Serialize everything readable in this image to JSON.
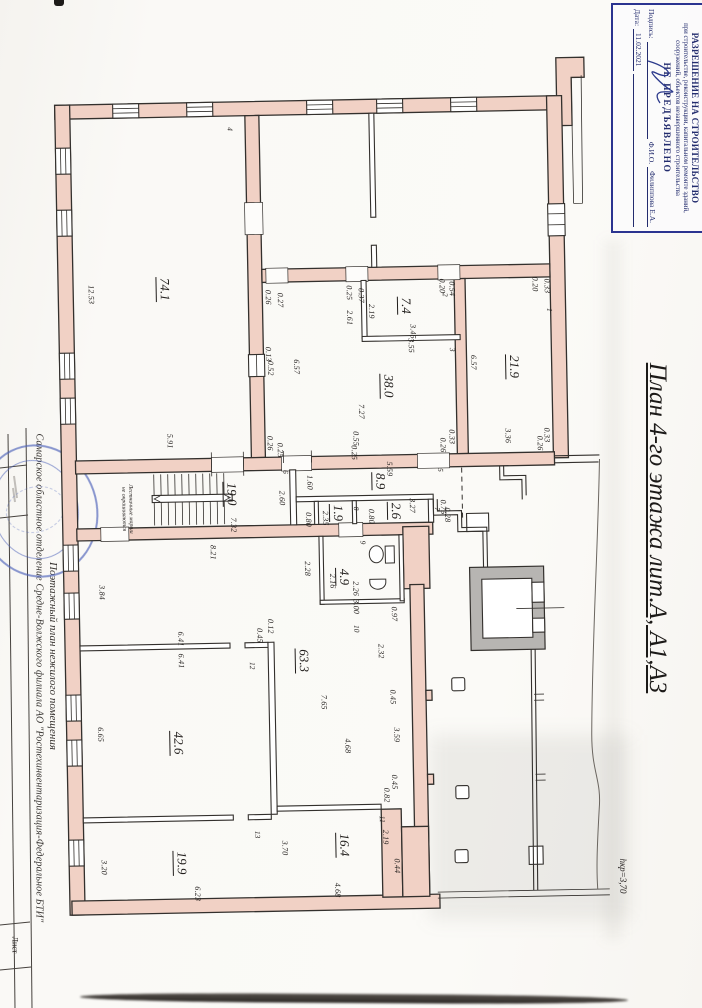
{
  "colors": {
    "wall": "#f1d1c5",
    "line": "#33302d",
    "stamp_blue": "#2b3490",
    "stamp_text": "#232c6e",
    "seal_blue": "#4a5fb8",
    "shaft_gray": "#b7b5b2",
    "paper": "#faf9f6"
  },
  "document": {
    "title_vertical": "План 4-го этажа лит.А, А1,А3",
    "height_note": "hкр=3,70",
    "left_margin": {
      "organization": "Самарское областное отделение Средне-Волжского филиала АО \"Ростехинвентаризация-Федеральное БТИ\"",
      "plan_type": "Поэтажный план нежилого помещения",
      "sheet_label": "Лист"
    },
    "permit_stamp": {
      "line1": "РАЗРЕШЕНИЕ НА СТРОИТЕЛЬСТВО",
      "line2": "при строительстве, реконструкции, капитальном ремонте зданий, сооружений, объектов незавершенного строительства",
      "line3": "НЕ ПРЕДЪЯВЛЕНО",
      "signature_label": "Подпись:",
      "fio_label": "Ф.И.О.",
      "fio_value": "Филиппова Е.А.",
      "date_label": "Дата:",
      "date_value": "11.02.2021"
    },
    "stairs_note_line1": "Лестничные марши",
    "stairs_note_line2": "не окрашиваются"
  },
  "plan": {
    "rooms": [
      {
        "number": "4",
        "area": "74.1",
        "ax": 106,
        "ay": 198,
        "nx": 175,
        "ny": 39
      },
      {
        "number": "2",
        "area": "7.4",
        "ax": 347,
        "ay": 219,
        "nx": 387,
        "ny": 209
      },
      {
        "number": "3",
        "area": "38.0",
        "ax": 328,
        "ay": 299,
        "nx": 393,
        "ny": 264
      },
      {
        "number": "1",
        "area": "21.9",
        "ax": 454,
        "ay": 282,
        "nx": 491,
        "ny": 226
      },
      {
        "number": "6",
        "area": "19.0",
        "ax": 169,
        "ay": 404,
        "nx": 224,
        "ny": 383
      },
      {
        "number": "5",
        "area": "8.9",
        "ax": 318,
        "ay": 394,
        "nx": 379,
        "ny": 384
      },
      {
        "number": "8",
        "area": "1.9",
        "ax": 275,
        "ay": 425,
        "nx": 294,
        "ny": 421
      },
      {
        "number": "7",
        "area": "2.6",
        "ax": 333,
        "ay": 424,
        "nx": 375,
        "ny": 423
      },
      {
        "number": "9",
        "area": "4.9",
        "ax": 280,
        "ay": 489,
        "nx": 300,
        "ny": 455
      },
      {
        "number": "10",
        "area": "63.3",
        "ax": 238,
        "ay": 572,
        "nx": 292,
        "ny": 541
      },
      {
        "number": "12",
        "area": "42.6",
        "ax": 111,
        "ay": 652,
        "nx": 187,
        "ny": 576
      },
      {
        "number": "13",
        "area": "19.9",
        "ax": 112,
        "ay": 772,
        "nx": 189,
        "ny": 745
      },
      {
        "number": "11",
        "area": "16.4",
        "ax": 275,
        "ay": 757,
        "nx": 314,
        "ny": 732
      }
    ],
    "dimensions": [
      [
        "12.53",
        33,
        202
      ],
      [
        "5.91",
        109,
        350
      ],
      [
        "0.26",
        210,
        208
      ],
      [
        "0.27",
        222,
        211
      ],
      [
        "0.25",
        291,
        205
      ],
      [
        "0.37",
        303,
        208
      ],
      [
        "0.20",
        384,
        200
      ],
      [
        "0.54",
        394,
        203
      ],
      [
        "2.61",
        291,
        230
      ],
      [
        "2.19",
        313,
        224
      ],
      [
        "3.45",
        354,
        245
      ],
      [
        "3.55",
        352,
        259
      ],
      [
        "0.13",
        209,
        265
      ],
      [
        "0.52",
        211,
        279
      ],
      [
        "6.57",
        237,
        278
      ],
      [
        "7.27",
        301,
        324
      ],
      [
        "0.26",
        209,
        354
      ],
      [
        "0.25",
        219,
        361
      ],
      [
        "0.55",
        295,
        351
      ],
      [
        "0.25",
        293,
        365
      ],
      [
        "0.33",
        391,
        351
      ],
      [
        "0.26",
        382,
        359
      ],
      [
        "0.20",
        477,
        200
      ],
      [
        "0.33",
        489,
        202
      ],
      [
        "6.57",
        414,
        277
      ],
      [
        "3.36",
        447,
        351
      ],
      [
        "0.33",
        486,
        351
      ],
      [
        "0.26",
        479,
        359
      ],
      [
        "5.59",
        328,
        382
      ],
      [
        "1.60",
        248,
        394
      ],
      [
        "2.60",
        220,
        409
      ],
      [
        "7.32",
        171,
        435
      ],
      [
        "0.80",
        246,
        431
      ],
      [
        "2.35",
        263,
        430
      ],
      [
        "0.80",
        309,
        429
      ],
      [
        "3.27",
        350,
        419
      ],
      [
        "0.75",
        381,
        421
      ],
      [
        "0.28",
        385,
        429
      ],
      [
        "2.16",
        269,
        493
      ],
      [
        "2.26",
        292,
        501
      ],
      [
        "3.00",
        292,
        519
      ],
      [
        "0.97",
        330,
        527
      ],
      [
        "2.28",
        244,
        480
      ],
      [
        "8.21",
        150,
        462
      ],
      [
        "3.84",
        38,
        500
      ],
      [
        "6.41",
        116,
        548
      ],
      [
        "6.41",
        116,
        570
      ],
      [
        "0.45",
        195,
        546
      ],
      [
        "0.12",
        206,
        537
      ],
      [
        "2.32",
        316,
        564
      ],
      [
        "0.45",
        327,
        610
      ],
      [
        "3.59",
        330,
        648
      ],
      [
        "0.45",
        327,
        695
      ],
      [
        "0.82",
        319,
        708
      ],
      [
        "2.19",
        317,
        750
      ],
      [
        "0.44",
        328,
        779
      ],
      [
        "7.65",
        258,
        614
      ],
      [
        "6.65",
        34,
        642
      ],
      [
        "4.68",
        281,
        658
      ],
      [
        "3.20",
        35,
        775
      ],
      [
        "6.23",
        128,
        803
      ],
      [
        "3.70",
        216,
        759
      ],
      [
        "4.68",
        268,
        802
      ]
    ]
  }
}
